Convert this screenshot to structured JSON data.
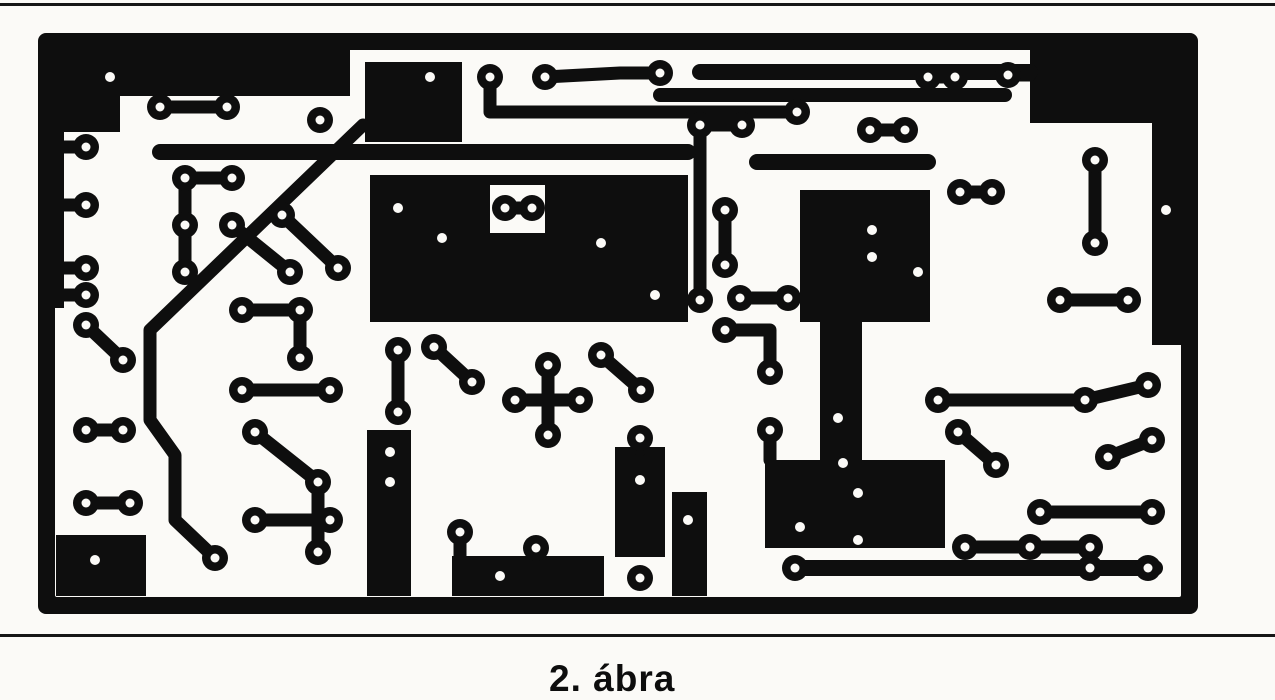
{
  "figure": {
    "caption": "2. ábra"
  },
  "colors": {
    "ink": "#0e0e0e",
    "paper": "#fbfaf7"
  },
  "pcb": {
    "frame": {
      "x": 38,
      "y": 33,
      "w": 1160,
      "h": 581,
      "border": 17,
      "corner": 8
    },
    "pours": [
      "M55 50H350V96H120V132H64V308H55Z",
      "M365 62H462V142H365Z",
      "M370 175H688V322H370Z",
      "M1030 50H1181V345H1152V123H1030Z",
      "M800 190H930V322H862V460H820V322H800Z",
      "M765 460H945V548H765Z",
      "M56 535H146V596H56Z",
      "M452 556H604V596H452Z",
      "M367 430H411V596H367Z",
      "M672 492H707V596H672Z",
      "M615 447H665V557H615Z"
    ],
    "notches": [
      [
        490,
        185,
        55,
        48
      ]
    ],
    "trace_w": 13,
    "pad_r": 13,
    "hole_r": 4.5,
    "traces": [
      {
        "p": [
          [
            160,
            107
          ],
          [
            227,
            107
          ]
        ]
      },
      {
        "p": [
          [
            86,
            147
          ],
          [
            64,
            147
          ]
        ]
      },
      {
        "p": [
          [
            86,
            205
          ],
          [
            64,
            205
          ]
        ]
      },
      {
        "p": [
          [
            86,
            268
          ],
          [
            64,
            268
          ]
        ]
      },
      {
        "p": [
          [
            86,
            295
          ],
          [
            64,
            295
          ]
        ]
      },
      {
        "p": [
          [
            86,
            325
          ],
          [
            123,
            360
          ]
        ]
      },
      {
        "p": [
          [
            86,
            430
          ],
          [
            123,
            430
          ]
        ]
      },
      {
        "p": [
          [
            86,
            503
          ],
          [
            130,
            503
          ]
        ]
      },
      {
        "p": [
          [
            363,
            125
          ],
          [
            150,
            330
          ],
          [
            150,
            420
          ],
          [
            175,
            455
          ],
          [
            175,
            520
          ],
          [
            215,
            558
          ]
        ]
      },
      {
        "p": [
          [
            185,
            178
          ],
          [
            185,
            272
          ]
        ]
      },
      {
        "p": [
          [
            185,
            178
          ],
          [
            232,
            178
          ]
        ]
      },
      {
        "p": [
          [
            232,
            225
          ],
          [
            290,
            272
          ]
        ]
      },
      {
        "p": [
          [
            282,
            215
          ],
          [
            338,
            268
          ]
        ]
      },
      {
        "p": [
          [
            242,
            310
          ],
          [
            300,
            310
          ]
        ]
      },
      {
        "p": [
          [
            300,
            310
          ],
          [
            300,
            358
          ]
        ]
      },
      {
        "p": [
          [
            242,
            390
          ],
          [
            330,
            390
          ]
        ]
      },
      {
        "p": [
          [
            255,
            432
          ],
          [
            318,
            482
          ]
        ]
      },
      {
        "p": [
          [
            255,
            520
          ],
          [
            330,
            520
          ]
        ]
      },
      {
        "p": [
          [
            318,
            482
          ],
          [
            318,
            552
          ]
        ]
      },
      {
        "p": [
          [
            398,
            350
          ],
          [
            398,
            412
          ]
        ]
      },
      {
        "p": [
          [
            434,
            347
          ],
          [
            472,
            382
          ]
        ]
      },
      {
        "p": [
          [
            515,
            400
          ],
          [
            580,
            400
          ]
        ]
      },
      {
        "p": [
          [
            548,
            365
          ],
          [
            548,
            435
          ]
        ]
      },
      {
        "p": [
          [
            460,
            532
          ],
          [
            460,
            560
          ]
        ]
      },
      {
        "p": [
          [
            601,
            355
          ],
          [
            641,
            390
          ]
        ]
      },
      {
        "p": [
          [
            700,
            125
          ],
          [
            742,
            125
          ]
        ]
      },
      {
        "p": [
          [
            700,
            125
          ],
          [
            700,
            300
          ]
        ]
      },
      {
        "p": [
          [
            725,
            210
          ],
          [
            725,
            265
          ]
        ]
      },
      {
        "p": [
          [
            740,
            298
          ],
          [
            788,
            298
          ]
        ]
      },
      {
        "p": [
          [
            725,
            330
          ],
          [
            770,
            330
          ],
          [
            770,
            372
          ]
        ]
      },
      {
        "p": [
          [
            770,
            430
          ],
          [
            770,
            460
          ]
        ]
      },
      {
        "p": [
          [
            490,
            77
          ],
          [
            490,
            112
          ],
          [
            797,
            112
          ]
        ]
      },
      {
        "p": [
          [
            545,
            77
          ],
          [
            620,
            73
          ],
          [
            660,
            73
          ]
        ]
      },
      {
        "p": [
          [
            928,
            77
          ],
          [
            955,
            77
          ]
        ]
      },
      {
        "p": [
          [
            1008,
            75
          ],
          [
            1030,
            75
          ]
        ]
      },
      {
        "p": [
          [
            960,
            192
          ],
          [
            992,
            192
          ]
        ]
      },
      {
        "p": [
          [
            1095,
            160
          ],
          [
            1095,
            243
          ]
        ]
      },
      {
        "p": [
          [
            1060,
            300
          ],
          [
            1128,
            300
          ]
        ]
      },
      {
        "p": [
          [
            938,
            400
          ],
          [
            1085,
            400
          ],
          [
            1148,
            385
          ]
        ]
      },
      {
        "p": [
          [
            958,
            432
          ],
          [
            996,
            465
          ]
        ]
      },
      {
        "p": [
          [
            1108,
            457
          ],
          [
            1152,
            440
          ]
        ]
      },
      {
        "p": [
          [
            1040,
            512
          ],
          [
            1152,
            512
          ]
        ]
      },
      {
        "p": [
          [
            965,
            547
          ],
          [
            1090,
            547
          ]
        ]
      },
      {
        "p": [
          [
            870,
            130
          ],
          [
            905,
            130
          ]
        ]
      },
      {
        "p": [
          [
            640,
            438
          ],
          [
            640,
            450
          ]
        ]
      },
      {
        "p": [
          [
            536,
            548
          ],
          [
            536,
            558
          ]
        ]
      },
      {
        "p": [
          [
            505,
            208
          ],
          [
            532,
            208
          ]
        ]
      },
      {
        "w": 16,
        "p": [
          [
            160,
            152
          ],
          [
            688,
            152
          ]
        ]
      },
      {
        "w": 16,
        "p": [
          [
            700,
            72
          ],
          [
            1030,
            72
          ]
        ]
      },
      {
        "w": 14,
        "p": [
          [
            660,
            95
          ],
          [
            1005,
            95
          ]
        ]
      },
      {
        "w": 16,
        "p": [
          [
            757,
            162
          ],
          [
            928,
            162
          ]
        ]
      },
      {
        "w": 16,
        "p": [
          [
            795,
            568
          ],
          [
            1155,
            568
          ]
        ]
      }
    ],
    "pads": [
      [
        160,
        107
      ],
      [
        227,
        107
      ],
      [
        86,
        147
      ],
      [
        86,
        205
      ],
      [
        86,
        268
      ],
      [
        86,
        295
      ],
      [
        86,
        325
      ],
      [
        123,
        360
      ],
      [
        86,
        430
      ],
      [
        123,
        430
      ],
      [
        86,
        503
      ],
      [
        130,
        503
      ],
      [
        215,
        558
      ],
      [
        185,
        178
      ],
      [
        185,
        225
      ],
      [
        185,
        272
      ],
      [
        232,
        178
      ],
      [
        232,
        225
      ],
      [
        290,
        272
      ],
      [
        282,
        215
      ],
      [
        338,
        268
      ],
      [
        242,
        310
      ],
      [
        300,
        310
      ],
      [
        300,
        358
      ],
      [
        242,
        390
      ],
      [
        330,
        390
      ],
      [
        255,
        432
      ],
      [
        318,
        482
      ],
      [
        255,
        520
      ],
      [
        330,
        520
      ],
      [
        318,
        552
      ],
      [
        398,
        350
      ],
      [
        398,
        412
      ],
      [
        434,
        347
      ],
      [
        472,
        382
      ],
      [
        515,
        400
      ],
      [
        580,
        400
      ],
      [
        548,
        365
      ],
      [
        548,
        435
      ],
      [
        460,
        532
      ],
      [
        601,
        355
      ],
      [
        641,
        390
      ],
      [
        700,
        125
      ],
      [
        742,
        125
      ],
      [
        700,
        300
      ],
      [
        725,
        210
      ],
      [
        725,
        265
      ],
      [
        740,
        298
      ],
      [
        788,
        298
      ],
      [
        725,
        330
      ],
      [
        770,
        372
      ],
      [
        770,
        430
      ],
      [
        490,
        77
      ],
      [
        545,
        77
      ],
      [
        660,
        73
      ],
      [
        797,
        112
      ],
      [
        928,
        77
      ],
      [
        955,
        77
      ],
      [
        1008,
        75
      ],
      [
        960,
        192
      ],
      [
        992,
        192
      ],
      [
        1095,
        160
      ],
      [
        1095,
        243
      ],
      [
        1060,
        300
      ],
      [
        1128,
        300
      ],
      [
        938,
        400
      ],
      [
        1085,
        400
      ],
      [
        1148,
        385
      ],
      [
        958,
        432
      ],
      [
        996,
        465
      ],
      [
        1108,
        457
      ],
      [
        1152,
        440
      ],
      [
        1040,
        512
      ],
      [
        1152,
        512
      ],
      [
        965,
        547
      ],
      [
        1030,
        547
      ],
      [
        1090,
        547
      ],
      [
        795,
        568
      ],
      [
        1090,
        568
      ],
      [
        1148,
        568
      ],
      [
        870,
        130
      ],
      [
        905,
        130
      ],
      [
        640,
        438
      ],
      [
        536,
        548
      ],
      [
        505,
        208
      ],
      [
        532,
        208
      ],
      [
        320,
        120
      ],
      [
        640,
        578
      ]
    ],
    "holes": [
      [
        110,
        77
      ],
      [
        430,
        77
      ],
      [
        398,
        208
      ],
      [
        442,
        238
      ],
      [
        601,
        243
      ],
      [
        655,
        295
      ],
      [
        872,
        230
      ],
      [
        872,
        257
      ],
      [
        918,
        272
      ],
      [
        838,
        418
      ],
      [
        843,
        463
      ],
      [
        858,
        493
      ],
      [
        800,
        527
      ],
      [
        858,
        540
      ],
      [
        1166,
        210
      ],
      [
        390,
        452
      ],
      [
        390,
        482
      ],
      [
        688,
        520
      ],
      [
        95,
        560
      ],
      [
        500,
        576
      ],
      [
        640,
        480
      ]
    ]
  }
}
